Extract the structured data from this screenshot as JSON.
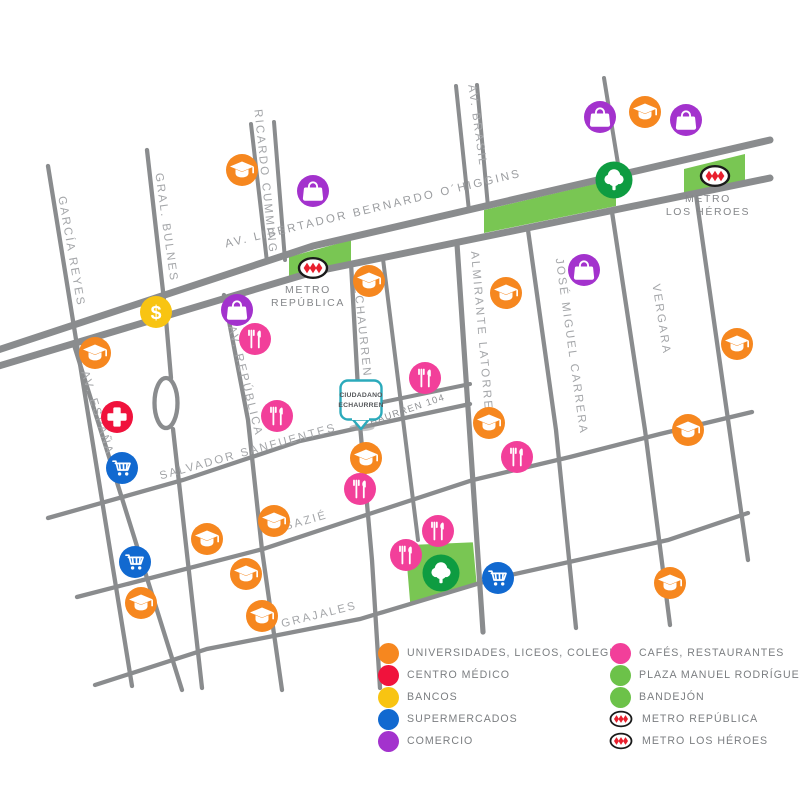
{
  "colors": {
    "orange": "#F6871F",
    "red": "#F0123C",
    "yellow": "#F8C412",
    "blue": "#1169D0",
    "purple": "#A332CD",
    "pink": "#F23F9A",
    "green": "#6CC249",
    "green_light": "#79C653",
    "green_dark": "#0E9C41",
    "street_gray": "#8A8C8E",
    "teal": "#2BAABB",
    "metro_red": "#E8202E"
  },
  "map": {
    "avenue_label": "AV. LIBERTADOR BERNARDO O´HIGGINS",
    "streets": {
      "garcia_reyes": "GARCÍA REYES",
      "gral_bulnes": "GRAL. BULNES",
      "ricardo_cumming": "RICARDO CUMMING",
      "av_brasil": "AV. BRASIL",
      "echaurren": "ECHAURREN",
      "av_republica": "AV. REPÚBLICA",
      "almirante_latorre": "ALMIRANTE LATORRE",
      "jose_miguel_carrera": "JOSÉ MIGUEL CARRERA",
      "vergara": "VERGARA",
      "av_espana": "AV. ESPAÑA",
      "salvador_sanfuentes": "SALVADOR SANFUENTES",
      "sazie": "SAZIÉ",
      "grajales": "GRAJALES"
    },
    "address_label": "ECHAURREN 104",
    "metro_republica": {
      "line1": "METRO",
      "line2": "REPÚBLICA"
    },
    "metro_los_heroes": {
      "line1": "METRO",
      "line2": "LOS HÉROES"
    },
    "callout": {
      "line1": "CIUDADANO",
      "line2": "ECHAURREN"
    },
    "markers": [
      {
        "type": "university",
        "x": 242,
        "y": 170
      },
      {
        "type": "university",
        "x": 645,
        "y": 112
      },
      {
        "type": "university",
        "x": 95,
        "y": 353
      },
      {
        "type": "university",
        "x": 369,
        "y": 281
      },
      {
        "type": "university",
        "x": 506,
        "y": 293
      },
      {
        "type": "university",
        "x": 737,
        "y": 344
      },
      {
        "type": "university",
        "x": 366,
        "y": 458
      },
      {
        "type": "university",
        "x": 489,
        "y": 423
      },
      {
        "type": "university",
        "x": 688,
        "y": 430
      },
      {
        "type": "university",
        "x": 274,
        "y": 521
      },
      {
        "type": "university",
        "x": 207,
        "y": 539
      },
      {
        "type": "university",
        "x": 246,
        "y": 574
      },
      {
        "type": "university",
        "x": 141,
        "y": 603
      },
      {
        "type": "university",
        "x": 262,
        "y": 616
      },
      {
        "type": "university",
        "x": 670,
        "y": 583
      },
      {
        "type": "commerce",
        "x": 313,
        "y": 191
      },
      {
        "type": "commerce",
        "x": 600,
        "y": 117
      },
      {
        "type": "commerce",
        "x": 686,
        "y": 120
      },
      {
        "type": "commerce",
        "x": 237,
        "y": 310
      },
      {
        "type": "commerce",
        "x": 584,
        "y": 270
      },
      {
        "type": "bank",
        "x": 156,
        "y": 312
      },
      {
        "type": "medical",
        "x": 117,
        "y": 417
      },
      {
        "type": "supermarket",
        "x": 122,
        "y": 468
      },
      {
        "type": "supermarket",
        "x": 135,
        "y": 562
      },
      {
        "type": "supermarket",
        "x": 498,
        "y": 578
      },
      {
        "type": "restaurant",
        "x": 255,
        "y": 339
      },
      {
        "type": "restaurant",
        "x": 277,
        "y": 416
      },
      {
        "type": "restaurant",
        "x": 425,
        "y": 378
      },
      {
        "type": "restaurant",
        "x": 360,
        "y": 489
      },
      {
        "type": "restaurant",
        "x": 517,
        "y": 457
      },
      {
        "type": "restaurant",
        "x": 438,
        "y": 531
      },
      {
        "type": "restaurant",
        "x": 406,
        "y": 555
      },
      {
        "type": "tree",
        "x": 614,
        "y": 180
      },
      {
        "type": "tree",
        "x": 441,
        "y": 573
      },
      {
        "type": "metro",
        "x": 313,
        "y": 268
      },
      {
        "type": "metro",
        "x": 715,
        "y": 176
      }
    ]
  },
  "legend": {
    "left": [
      {
        "label": "UNIVERSIDADES, LICEOS, COLEGIOS",
        "icon": "dot",
        "color_key": "orange"
      },
      {
        "label": "CENTRO MÉDICO",
        "icon": "dot",
        "color_key": "red"
      },
      {
        "label": "BANCOS",
        "icon": "dot",
        "color_key": "yellow"
      },
      {
        "label": "SUPERMERCADOS",
        "icon": "dot",
        "color_key": "blue"
      },
      {
        "label": "COMERCIO",
        "icon": "dot",
        "color_key": "purple"
      }
    ],
    "right": [
      {
        "label": "CAFÉS, RESTAURANTES",
        "icon": "dot",
        "color_key": "pink"
      },
      {
        "label": "PLAZA MANUEL RODRÍGUEZ",
        "icon": "dot",
        "color_key": "green"
      },
      {
        "label": "BANDEJÓN",
        "icon": "dot",
        "color_key": "green"
      },
      {
        "label": "METRO REPÚBLICA",
        "icon": "metro"
      },
      {
        "label": "METRO LOS HÉROES",
        "icon": "metro"
      }
    ]
  }
}
